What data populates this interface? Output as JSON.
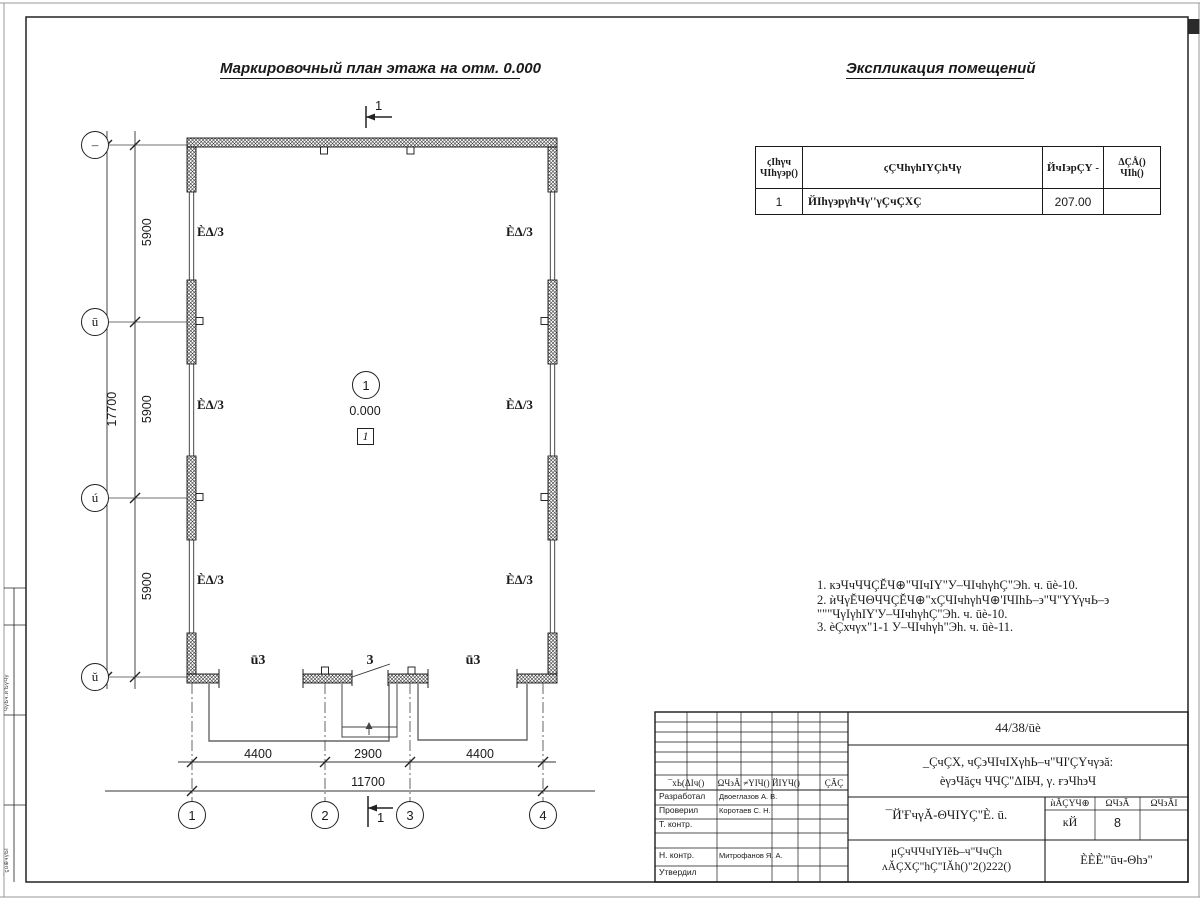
{
  "ink": "#1a1a1a",
  "headings": {
    "plan_title": "Маркировочный план этажа на отм. 0.000",
    "table_title": "Экспликация помещений"
  },
  "plan": {
    "axes_left": [
      "–",
      "ū",
      "ú",
      "ŭ"
    ],
    "axes_bottom": [
      "1",
      "2",
      "3",
      "4"
    ],
    "dims_vertical": [
      "5900",
      "5900",
      "5900"
    ],
    "dim_vertical_total": "17700",
    "dims_horizontal": [
      "4400",
      "2900",
      "4400"
    ],
    "dim_horizontal_total": "11700",
    "window_mark": "ÈΔ/3",
    "gate_mark": "ū3",
    "door_mark": "3",
    "room_number": "1",
    "elevation": "0.000",
    "room_box": "1",
    "section_mark": "1"
  },
  "room_table": {
    "col1_line1": "ϛΙһγч",
    "col1_line2": "ЧΙһγ϶р()",
    "col2": "ϛÇЧһγһΙΥÇһЧγ",
    "col3": "ЙчΙ϶рÇΥ -",
    "col4_line1": "ΔÇÅ()",
    "col4_line2": "ЧΙһ()",
    "rows": [
      {
        "num": "1",
        "name": "ЙΙһγ϶рγһЧγ''γÇчÇХÇ",
        "area": "207.00",
        "note": ""
      }
    ]
  },
  "notes": {
    "line1": "1. к϶ЧчЧЧÇĔЧ⊕\"ЧΙчΙΥ\"У–ЧΙчһγһÇ\"Эһ. ч. ūè-10.",
    "line2": "2. ѝЧγĔЧΘЧЧÇĔЧ⊕\"хÇЧΙчһγһЧ⊕'ΙЧΙһЬ–϶\"Ч\"ΥΥγчЬ–϶",
    "line3": "\"\"\"ЧγΙγһΙΥ'У–ЧΙчһγһÇ\"Эһ. ч. ūè-10.",
    "line4": "3. èÇхчγх\"1-1 У–ЧΙчһγһ\"Эһ. ч. ūè-11."
  },
  "title_block": {
    "doc_number": "44/38/ūè",
    "project_line1": "_ÇчÇХ, чÇ϶ЧΙчΙХγһЬ–ч\"ЧΙ'ÇΥчγ϶ă:",
    "project_line2": "èγ϶Чăçч ЧЧÇ\"ΔΙЬЧ, γ. ғ϶Чһ϶Ч",
    "sheet_title": "¯Й'ҒчγĂ-ΘЧΙΥÇ\"È. ū.",
    "org_line1": "μÇчЧЧчΙΥΙĕЬ–ч\"ЧчÇһ",
    "org_line2": "ʌĂÇХÇ\"һÇ\"ΙĂһ()\"2()222()",
    "company": "ÈÈÈ'\"ūч-Θһ϶\"",
    "stage_header": "ѝĂÇΥЧ⊕",
    "sheet_header": "ΩЧ϶Ă",
    "sheets_header": "ΩЧ϶ĂΙ",
    "stage_value": "кЙ",
    "sheet_value": "8",
    "sheets_value": "",
    "sig_headers": [
      "¯хЬ(ΔΙч()",
      "ΩЧ϶Ă",
      "≠YΙЧ()",
      "ЙΙΥЧ()",
      "",
      "ÇĂÇ"
    ],
    "roles": [
      {
        "role": "Разработал",
        "name": "Двоеглазов А. В."
      },
      {
        "role": "Проверил",
        "name": "Коротаев С. Н."
      },
      {
        "role": "Т. контр.",
        "name": ""
      },
      {
        "role": "",
        "name": ""
      },
      {
        "role": "Н. контр.",
        "name": "Митрофанов Я. А."
      },
      {
        "role": "Утвердил",
        "name": ""
      }
    ]
  },
  "margin": {
    "cell1": "ЧγЬч.ѝ'ЬγЧγ",
    "cell2": "¯ϛù⊕чγЬΙ"
  }
}
